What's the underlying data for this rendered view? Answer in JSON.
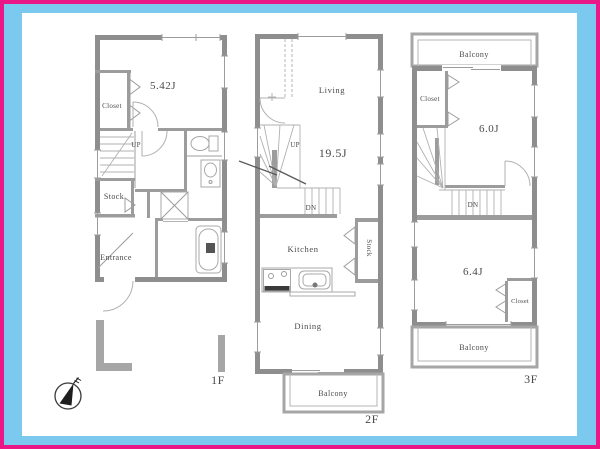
{
  "colors": {
    "border_outer": "#ea1787",
    "border_inner": "#7bc9ee",
    "canvas": "#ffffff",
    "wall": "#8e8e8e",
    "interior_wall": "#9c9c9c",
    "text": "#4a4a4a"
  },
  "icons": {
    "compass": "north-arrow"
  },
  "floor1": {
    "label": "1F",
    "room_main": "5.42J",
    "closet": "Closet",
    "up": "UP",
    "stock": "Stock",
    "entrance": "Entrance"
  },
  "floor2": {
    "label": "2F",
    "living": "Living",
    "area": "19.5J",
    "up": "UP",
    "down": "DN",
    "kitchen": "Kitchen",
    "stock": "Stock",
    "dining": "Dining",
    "balcony": "Balcony"
  },
  "floor3": {
    "label": "3F",
    "balcony_top": "Balcony",
    "closet_top": "Closet",
    "room_top": "6.0J",
    "down": "DN",
    "room_bottom": "6.4J",
    "closet_bottom": "Closet",
    "balcony_bottom": "Balcony"
  }
}
